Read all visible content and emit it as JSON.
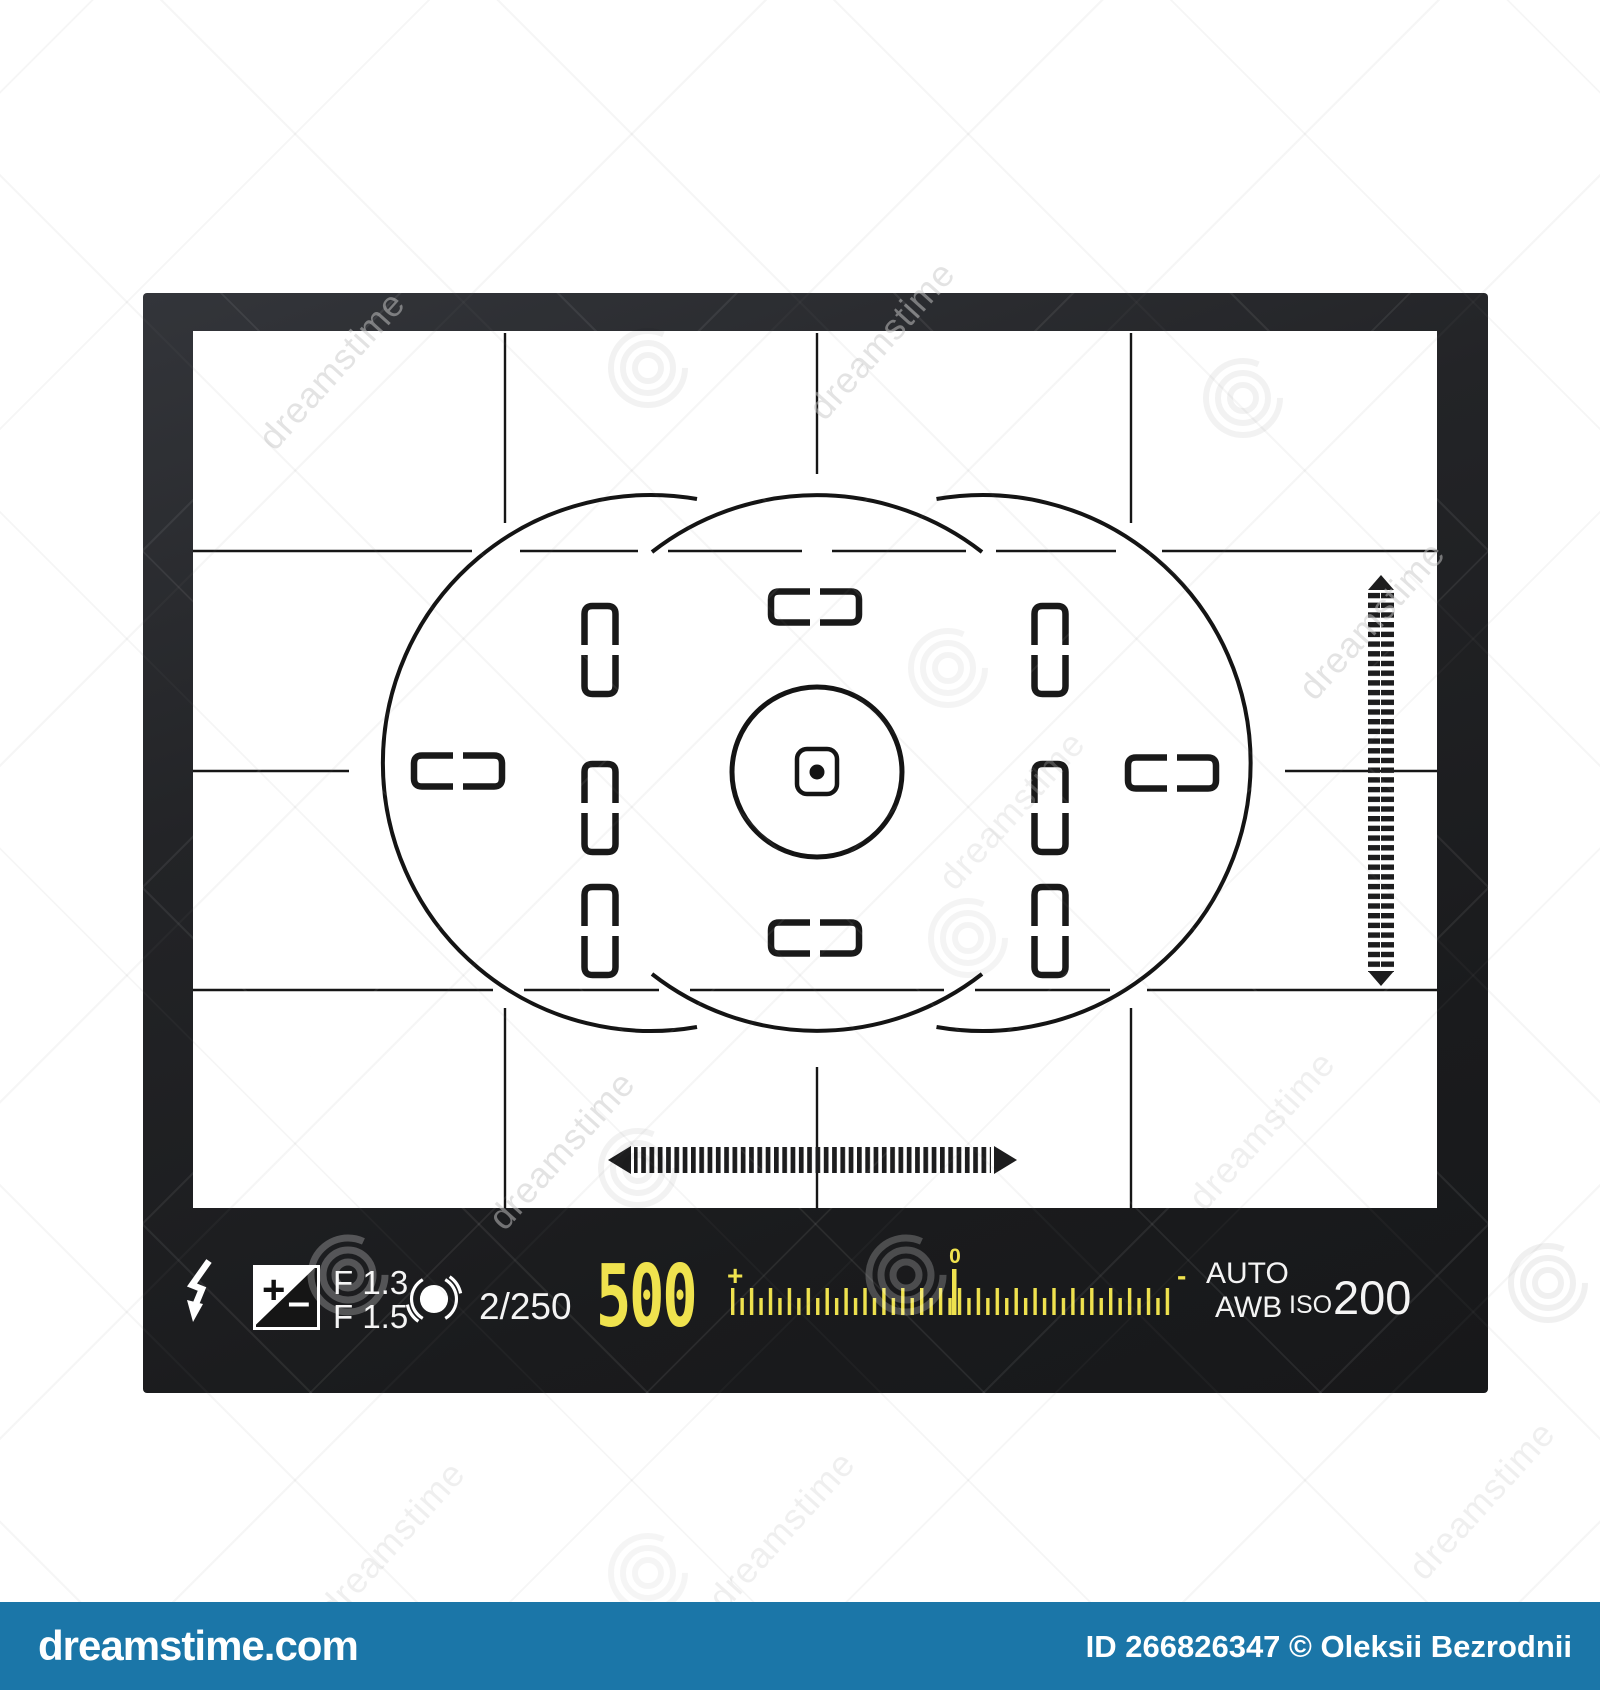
{
  "watermark": {
    "brand": "dreamstime",
    "site": "dreamstime.com",
    "credit": "ID 266826347 © Oleksii Bezrodnii"
  },
  "viewfinder": {
    "statusbar": {
      "aperture_low": "F 1.3",
      "aperture_high": "F 1.5",
      "exp_comp_plus": "+",
      "exp_comp_minus": "–",
      "frame_counter": "2/250",
      "shutter_speed": "500",
      "meter_plus": "+",
      "meter_zero": "0",
      "meter_minus": "-",
      "wb_mode": "AUTO",
      "wb_type": "AWB",
      "iso_label": "ISO",
      "iso_value": "200"
    },
    "colors": {
      "accent_yellow": "#efe24e",
      "bar_blue": "#1b76a8",
      "frame_dark": "#1a1b1d"
    }
  }
}
